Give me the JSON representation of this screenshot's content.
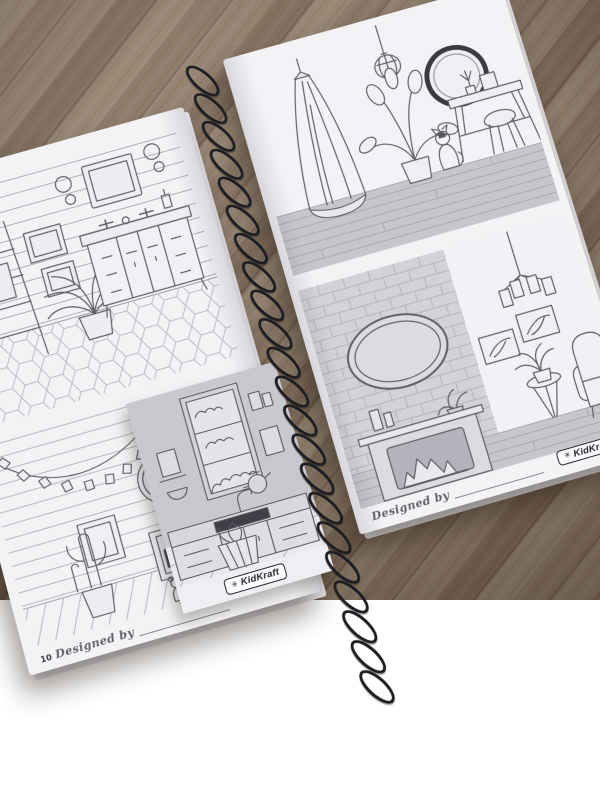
{
  "book": {
    "brand": "KidKraft",
    "logo_icon": "✳",
    "left_page": {
      "page_number": "10",
      "designed_by_label": "Designed by"
    },
    "right_page": {
      "page_number": "11",
      "designed_by_label": "Designed by"
    }
  },
  "colors": {
    "wood_base": "#8a7666",
    "page_white": "#f3f2f5",
    "insert_wall_grey": "#c9c8ce",
    "floor_band_grey": "#c7c6cd",
    "ink_line": "#60606a",
    "coil_black": "#1e1e22"
  },
  "drawings": {
    "left_top": "bathroom vanity with ladder shelf, mirror, plant and hex tile floor",
    "left_bottom": "kids room with pennant banner, round mirror, framed house art, cactus, ball and teddy bear",
    "insert": "kitchen sink with window, cabinets and basket of flowers",
    "right_top": "bedroom with pendant lamp, canopy, plant, cat, vanity table and stool",
    "right_bottom": "living room with brick wall, oval mirror, fireplace, chandelier, armchair and plant table"
  }
}
